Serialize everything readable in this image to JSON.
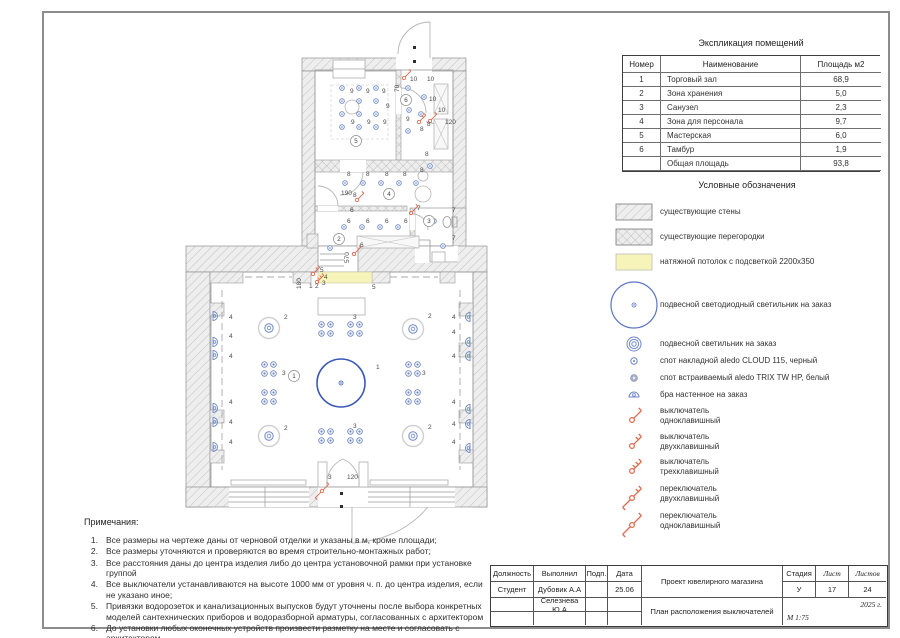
{
  "colors": {
    "accent_blue": "#3a57b8",
    "spot_blue": "#6d87c6",
    "switch_red": "#dd6a4e",
    "ceiling_yellow": "#f7f4b9",
    "wall_hatch": "#c0c0c0"
  },
  "explication": {
    "title": "Экспликация помещений",
    "columns": [
      "Номер",
      "Наименование",
      "Площадь м2"
    ],
    "rows": [
      [
        "1",
        "Торговый зал",
        "68,9"
      ],
      [
        "2",
        "Зона хранения",
        "5,0"
      ],
      [
        "3",
        "Санузел",
        "2,3"
      ],
      [
        "4",
        "Зона для персонала",
        "9,7"
      ],
      [
        "5",
        "Мастерская",
        "6,0"
      ],
      [
        "6",
        "Тамбур",
        "1,9"
      ],
      [
        "",
        "Общая площадь",
        "93,8"
      ]
    ]
  },
  "legend": {
    "title": "Условные обозначения",
    "items": [
      {
        "sym": "hatch",
        "label": "существующие стены",
        "top": 23,
        "h": 18
      },
      {
        "sym": "cross",
        "label": "существующие перегородки",
        "top": 48,
        "h": 18
      },
      {
        "sym": "ceiling",
        "label": "натяжной потолок с подсветкой 2200х350",
        "top": 73,
        "h": 18
      },
      {
        "sym": "bigpendant",
        "label": "подвесной светодиодный светильник на заказ",
        "top": 99,
        "h": 52
      },
      {
        "sym": "pendant",
        "label": "подвесной светильник на заказ",
        "top": 156,
        "h": 16
      },
      {
        "sym": "spotsurf",
        "label": "спот накладной  aledo CLOUD 115, черный",
        "top": 173,
        "h": 16
      },
      {
        "sym": "spotrec",
        "label": "спот встраиваемый  aledo TRIX TW HP, белый",
        "top": 190,
        "h": 16
      },
      {
        "sym": "bra",
        "label": "бра настенное на заказ",
        "top": 207,
        "h": 16
      },
      {
        "sym": "sw1",
        "label": "выключатель\nодноклавишный",
        "top": 224,
        "h": 24
      },
      {
        "sym": "sw2",
        "label": "выключатель\nдвухклавишный",
        "top": 250,
        "h": 24
      },
      {
        "sym": "sw3",
        "label": "выключатель\nтрехклавишный",
        "top": 275,
        "h": 24
      },
      {
        "sym": "psw2",
        "label": "переключатель\nдвухклавишный",
        "top": 302,
        "h": 24
      },
      {
        "sym": "psw1",
        "label": "переключатель\nодноклавишный",
        "top": 329,
        "h": 24
      }
    ]
  },
  "notes": {
    "title": "Примечания:",
    "items": [
      "Все размеры на чертеже даны от черновой отделки и указаны в м, кроме площади;",
      "Все размеры уточняются  и проверяются во время строительно-монтажных работ;",
      "Все расстояния даны до центра изделия либо до центра установочной рамки при установке группой",
      "Все выключатели устанавливаются на высоте 1000 мм от уровня ч. п. до центра изделия, если не указано иное;",
      "Привязки водорозеток и канализационных выпусков будут уточнены после выбора конкретных моделей сантехнических приборов и водоразборной арматуры, согласованных с архитектором",
      "До установки любых оконечных устройств произвести разметку на месте и согласовать с архитектором"
    ]
  },
  "titleblock": {
    "labels": {
      "position": "Должность",
      "made_by": "Выполнил",
      "sign": "Подп.",
      "date": "Дата",
      "stage": "Стадия",
      "sheet": "Лист",
      "sheets": "Листов"
    },
    "values": {
      "position": "Студент",
      "author1": "Дубовик А.А",
      "date1": "25.06",
      "author2": "Селезнева Ю.А",
      "project": "Проект ювелирного магазина",
      "drawing": "План расположения выключателей",
      "stage": "У",
      "sheet_no": "17",
      "sheets_total": "24",
      "year": "2025 г.",
      "scale": "М 1:75"
    }
  },
  "plan": {
    "labels": [
      {
        "t": "9",
        "x": 350,
        "y": 93
      },
      {
        "t": "9",
        "x": 366,
        "y": 93
      },
      {
        "t": "9",
        "x": 382,
        "y": 93
      },
      {
        "t": "9",
        "x": 386,
        "y": 108
      },
      {
        "t": "9",
        "x": 351,
        "y": 124
      },
      {
        "t": "9",
        "x": 367,
        "y": 124
      },
      {
        "t": "9",
        "x": 383,
        "y": 124
      },
      {
        "t": "10",
        "x": 410,
        "y": 81
      },
      {
        "t": "10",
        "x": 427,
        "y": 81
      },
      {
        "t": "10",
        "x": 429,
        "y": 101
      },
      {
        "t": "10",
        "x": 438,
        "y": 112
      },
      {
        "t": "70",
        "x": 399,
        "y": 92,
        "r": -90
      },
      {
        "t": "120",
        "x": 445,
        "y": 124
      },
      {
        "t": "8",
        "x": 420,
        "y": 131
      },
      {
        "t": "8",
        "x": 427,
        "y": 126
      },
      {
        "t": "9",
        "x": 406,
        "y": 121
      },
      {
        "t": "8",
        "x": 425,
        "y": 156
      },
      {
        "t": "190",
        "x": 341,
        "y": 195
      },
      {
        "t": "8",
        "x": 347,
        "y": 176
      },
      {
        "t": "8",
        "x": 366,
        "y": 176
      },
      {
        "t": "8",
        "x": 385,
        "y": 176
      },
      {
        "t": "8",
        "x": 403,
        "y": 176
      },
      {
        "t": "8",
        "x": 420,
        "y": 172
      },
      {
        "t": "8",
        "x": 353,
        "y": 197
      },
      {
        "t": "6",
        "x": 350,
        "y": 212
      },
      {
        "t": "6",
        "x": 347,
        "y": 223
      },
      {
        "t": "6",
        "x": 366,
        "y": 223
      },
      {
        "t": "6",
        "x": 385,
        "y": 223
      },
      {
        "t": "6",
        "x": 404,
        "y": 223
      },
      {
        "t": "6",
        "x": 360,
        "y": 247
      },
      {
        "t": "7",
        "x": 417,
        "y": 210
      },
      {
        "t": "7",
        "x": 452,
        "y": 212
      },
      {
        "t": "7",
        "x": 452,
        "y": 240
      },
      {
        "t": "570",
        "x": 349,
        "y": 263,
        "r": -90
      },
      {
        "t": "180",
        "x": 301,
        "y": 289,
        "r": -90
      },
      {
        "t": "5",
        "x": 320,
        "y": 272
      },
      {
        "t": "4",
        "x": 324,
        "y": 279
      },
      {
        "t": "3",
        "x": 322,
        "y": 285
      },
      {
        "t": "1",
        "x": 309,
        "y": 288
      },
      {
        "t": "2",
        "x": 315,
        "y": 288
      },
      {
        "t": "5",
        "x": 372,
        "y": 289
      },
      {
        "t": "1",
        "x": 376,
        "y": 369
      },
      {
        "t": "2",
        "x": 284,
        "y": 319
      },
      {
        "t": "2",
        "x": 428,
        "y": 318
      },
      {
        "t": "2",
        "x": 284,
        "y": 430
      },
      {
        "t": "2",
        "x": 428,
        "y": 429
      },
      {
        "t": "3",
        "x": 353,
        "y": 319
      },
      {
        "t": "3",
        "x": 282,
        "y": 375
      },
      {
        "t": "3",
        "x": 422,
        "y": 375
      },
      {
        "t": "3",
        "x": 353,
        "y": 428
      },
      {
        "t": "3",
        "x": 328,
        "y": 479
      },
      {
        "t": "120",
        "x": 347,
        "y": 479
      },
      {
        "t": "4",
        "x": 229,
        "y": 319
      },
      {
        "t": "4",
        "x": 229,
        "y": 338
      },
      {
        "t": "4",
        "x": 229,
        "y": 358
      },
      {
        "t": "4",
        "x": 229,
        "y": 404
      },
      {
        "t": "4",
        "x": 229,
        "y": 424
      },
      {
        "t": "4",
        "x": 229,
        "y": 444
      },
      {
        "t": "4",
        "x": 452,
        "y": 319
      },
      {
        "t": "4",
        "x": 452,
        "y": 334
      },
      {
        "t": "4",
        "x": 452,
        "y": 358
      },
      {
        "t": "4",
        "x": 452,
        "y": 404
      },
      {
        "t": "4",
        "x": 452,
        "y": 426
      },
      {
        "t": "4",
        "x": 452,
        "y": 444
      }
    ],
    "circled": [
      {
        "n": "1",
        "x": 294,
        "y": 376
      },
      {
        "n": "2",
        "x": 339,
        "y": 239
      },
      {
        "n": "3",
        "x": 429,
        "y": 221
      },
      {
        "n": "4",
        "x": 389,
        "y": 194
      },
      {
        "n": "5",
        "x": 356,
        "y": 141
      },
      {
        "n": "6",
        "x": 406,
        "y": 100
      }
    ],
    "spots": [
      [
        342,
        88
      ],
      [
        359,
        88
      ],
      [
        376,
        88
      ],
      [
        342,
        101
      ],
      [
        359,
        101
      ],
      [
        376,
        101
      ],
      [
        342,
        114
      ],
      [
        359,
        114
      ],
      [
        376,
        114
      ],
      [
        342,
        127
      ],
      [
        359,
        127
      ],
      [
        376,
        127
      ],
      [
        408,
        88
      ],
      [
        424,
        97
      ],
      [
        409,
        110
      ],
      [
        421,
        114
      ],
      [
        408,
        131
      ],
      [
        345,
        183
      ],
      [
        363,
        183
      ],
      [
        381,
        183
      ],
      [
        399,
        183
      ],
      [
        416,
        183
      ],
      [
        430,
        166
      ],
      [
        344,
        227
      ],
      [
        362,
        227
      ],
      [
        380,
        227
      ],
      [
        398,
        227
      ],
      [
        434,
        221
      ],
      [
        443,
        246
      ],
      [
        330,
        248
      ]
    ],
    "pendants": [
      [
        269,
        328
      ],
      [
        413,
        329
      ],
      [
        269,
        436
      ],
      [
        413,
        436
      ]
    ],
    "clusters": [
      [
        326,
        329
      ],
      [
        355,
        329
      ],
      [
        269,
        369
      ],
      [
        269,
        397
      ],
      [
        413,
        369
      ],
      [
        413,
        397
      ],
      [
        326,
        436
      ],
      [
        355,
        436
      ]
    ],
    "bras": [
      {
        "x": 213,
        "y": 316,
        "s": 1
      },
      {
        "x": 213,
        "y": 342,
        "s": 1
      },
      {
        "x": 213,
        "y": 355,
        "s": 1
      },
      {
        "x": 213,
        "y": 408,
        "s": 1
      },
      {
        "x": 213,
        "y": 422,
        "s": 1
      },
      {
        "x": 213,
        "y": 447,
        "s": 1
      },
      {
        "x": 470,
        "y": 317,
        "s": -1
      },
      {
        "x": 470,
        "y": 342,
        "s": -1
      },
      {
        "x": 470,
        "y": 356,
        "s": -1
      },
      {
        "x": 470,
        "y": 409,
        "s": -1
      },
      {
        "x": 470,
        "y": 424,
        "s": -1
      },
      {
        "x": 470,
        "y": 448,
        "s": -1
      }
    ],
    "switches": [
      {
        "x": 313,
        "y": 274,
        "k": 2,
        "p": false
      },
      {
        "x": 317,
        "y": 282,
        "k": 3,
        "p": false
      },
      {
        "x": 354,
        "y": 254,
        "k": 1,
        "p": false
      },
      {
        "x": 357,
        "y": 200,
        "k": 1,
        "p": false
      },
      {
        "x": 404,
        "y": 78,
        "k": 1,
        "p": false
      },
      {
        "x": 419,
        "y": 122,
        "k": 2,
        "p": false
      },
      {
        "x": 430,
        "y": 121,
        "k": 1,
        "p": false
      },
      {
        "x": 411,
        "y": 213,
        "k": 1,
        "p": false
      },
      {
        "x": 322,
        "y": 491,
        "k": 1,
        "p": true
      }
    ],
    "crosses": [
      [
        357,
        236,
        62,
        12
      ],
      [
        434,
        84,
        14,
        30
      ],
      [
        434,
        119,
        14,
        30
      ]
    ],
    "furn_circles": [
      [
        352,
        107,
        7
      ],
      [
        423,
        176,
        5
      ],
      [
        423,
        194,
        8
      ]
    ],
    "center_light": {
      "x": 341,
      "y": 383,
      "r": 24
    }
  }
}
